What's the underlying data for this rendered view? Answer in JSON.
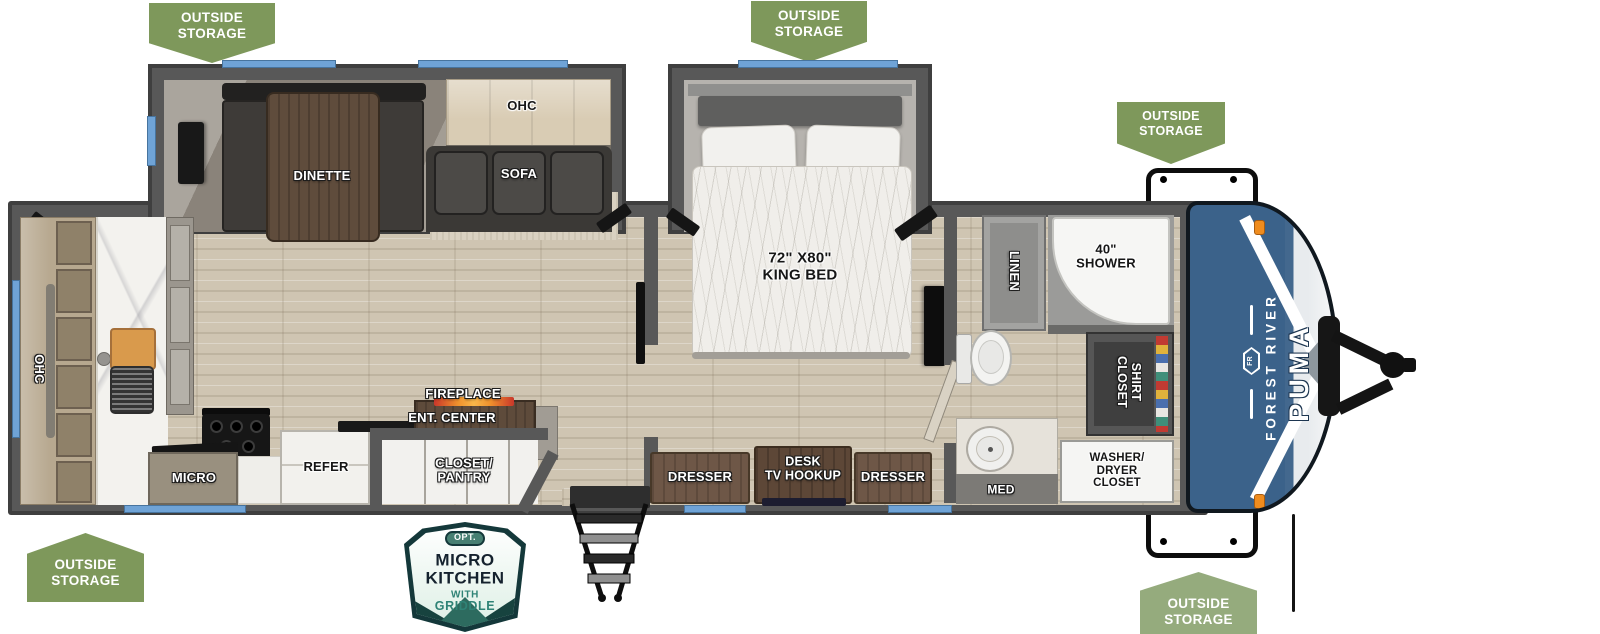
{
  "badge_text": "OUTSIDE\nSTORAGE",
  "labels": {
    "dinette": "DINETTE",
    "ohc": "OHC",
    "sofa": "SOFA",
    "king_bed": "72\" X80\"\nKING BED",
    "linen": "LINEN",
    "shower": "40\"\nSHOWER",
    "shirt_closet": "SHIRT\nCLOSET",
    "med": "MED",
    "washer_dryer": "WASHER/\nDRYER\nCLOSET",
    "dresser": "DRESSER",
    "desk_tv": "DESK\nTV HOOKUP",
    "fireplace": "FIREPLACE",
    "ent_center": "ENT. CENTER",
    "closet_pantry": "CLOSET/\nPANTRY",
    "refer": "REFER",
    "micro": "MICRO"
  },
  "brand": {
    "maker": "FOREST RIVER",
    "model": "PUMA",
    "emblem": "FR"
  },
  "option_badge": {
    "tag": "OPT.",
    "line1": "MICRO",
    "line2": "KITCHEN",
    "line3": "WITH",
    "line4": "GRIDDLE"
  },
  "colors": {
    "badge_green": "#7E985B",
    "badge_green_light": "#95AB7D",
    "window_blue": "#6FA3D6",
    "wall_gray": "#575757",
    "cap_blue": "#3B628A",
    "flame_orange": "#F0922D",
    "tv_blue": "#3A66C0",
    "accent_teal": "#2F8376",
    "option_badge_dark_teal": "#14383A"
  }
}
